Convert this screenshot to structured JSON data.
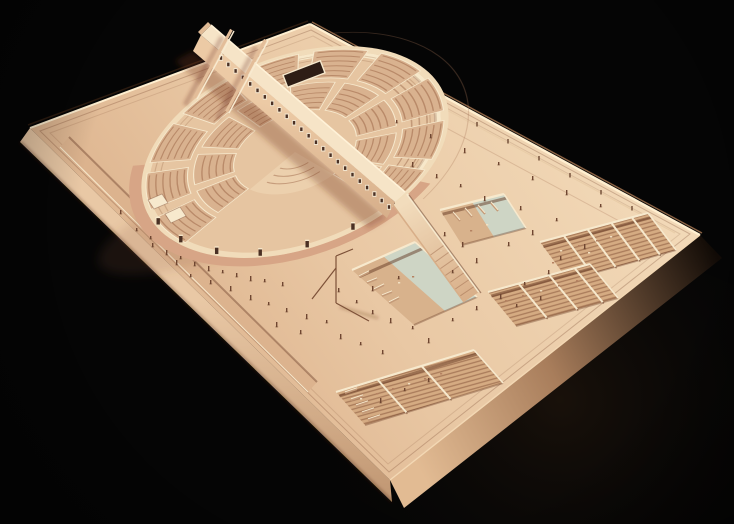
{
  "scene": {
    "description": "Photograph of a wooden architectural scale model on a black background: a circular open-air amphitheater with radial seating blocks, crossed by a long diagonal spine wall with a row of square windows, set on a large tilted rectangular plaza base with sunken rectangular courtyards, a descending ramp, a thin mast, and many tiny human figures.",
    "width": 734,
    "height": 524
  },
  "palette": {
    "bg": "#050505",
    "glow": "rgba(130,80,38,0.16)",
    "plaza_light": "#f4ddbc",
    "plaza_dark": "#d8ab85",
    "rim_groove": "rgba(120,70,45,0.30)",
    "edge_light": "#ffefd0",
    "edge_dark": "#2b1b10",
    "side_sw_hi": "#e9c8a5",
    "side_sw_lo": "#bf9571",
    "se_hi": "#e2bb93",
    "se_mid": "#a87d5b",
    "se_lo": "#120b06",
    "wall_top": "#f1dcba",
    "wall_shadow": "#d7a586",
    "bowl": "#e6c5a1",
    "inner_ne_wall": "#f7e8ca",
    "seat": "#d9b28f",
    "seat_stripe": "#b98a69",
    "stage_floor": "#ecd0ad",
    "cream": "#f7e9cd",
    "spine_top": "#f6e4c7",
    "spine_face_hi": "#eccaa5",
    "spine_face_lo": "#c99d79",
    "window_frame": "#f4e8d2",
    "window_hole": "#4a3024",
    "cast_shadow": "rgba(115,55,35,0.32)",
    "soft_shadow": "rgba(140,85,55,0.16)",
    "green_panel": "#ced5c5",
    "court_floor": "#d5ab82",
    "court_stripe": "#a97b5a",
    "court_wall_dark": "rgba(95,50,30,0.48)",
    "trench": "#dcb38e",
    "figure": "#6f4631",
    "figure_shadow": "rgba(90,50,30,0.40)",
    "mast": "#7d5138",
    "vignette": "rgba(0,0,0,0.36)"
  },
  "platform": {
    "top": [
      [
        310,
        24
      ],
      [
        700,
        235
      ],
      [
        390,
        480
      ],
      [
        30,
        128
      ]
    ],
    "inset1": [
      [
        311,
        30
      ],
      [
        690,
        234
      ],
      [
        389,
        472
      ],
      [
        40,
        131
      ]
    ],
    "inset2": [
      [
        313,
        36
      ],
      [
        680,
        234
      ],
      [
        388,
        464
      ],
      [
        50,
        133
      ]
    ],
    "side_sw": [
      [
        30,
        128
      ],
      [
        390,
        480
      ],
      [
        392,
        502
      ],
      [
        20,
        142
      ]
    ],
    "side_se": [
      [
        390,
        480
      ],
      [
        700,
        235
      ],
      [
        722,
        258
      ],
      [
        404,
        508
      ]
    ],
    "ne_wall_line": [
      [
        328,
        46
      ],
      [
        675,
        233
      ]
    ],
    "ne_seam": [
      [
        320,
        60
      ],
      [
        660,
        243
      ]
    ],
    "posts": [
      [
        383,
        75
      ],
      [
        414,
        92
      ],
      [
        445,
        109
      ],
      [
        477,
        126
      ],
      [
        508,
        143
      ],
      [
        539,
        160
      ],
      [
        570,
        177
      ],
      [
        601,
        194
      ],
      [
        632,
        210
      ]
    ],
    "trench": [
      [
        69,
        137
      ],
      [
        317,
        382
      ],
      [
        308,
        392
      ],
      [
        60,
        147
      ]
    ]
  },
  "drum": {
    "cx": 295,
    "cy": 152,
    "sx": 1.6,
    "sy": 0.96,
    "rot": -20.5,
    "r_outer": 100,
    "r_wall_in": 95,
    "r_bowl": 92,
    "outer_face_arc": [
      48,
      205,
      100,
      108
    ],
    "ne_wall_arc": [
      245,
      420,
      90.5,
      95
    ],
    "seam_r": 113,
    "seam_arc": [
      295,
      415
    ],
    "doors": [
      62,
      80,
      98,
      116,
      134,
      152,
      168
    ],
    "door_r": 98,
    "stage_sector": [
      64,
      150,
      0,
      40
    ],
    "stage_arcs": [
      16,
      23,
      30
    ],
    "terrace_arcs": [
      76,
      81,
      86,
      91
    ],
    "terrace_span": [
      332,
      414
    ],
    "concourse_arcs": [
      88,
      92
    ],
    "screen": {
      "x": 304,
      "y": 74,
      "w": 40,
      "h": 13,
      "rot": -21
    }
  },
  "seating": {
    "bandA": {
      "r": [
        40,
        66
      ],
      "row_step": 4.6,
      "wedges": [
        [
          152,
          178
        ],
        [
          184,
          210
        ],
        [
          216,
          242
        ],
        [
          248,
          274
        ],
        [
          280,
          306
        ],
        [
          312,
          338
        ],
        [
          344,
          370
        ],
        [
          376,
          402
        ],
        [
          404,
          424
        ]
      ]
    },
    "bandB": {
      "r": [
        70,
        97
      ],
      "row_step": 4.6,
      "wedges": [
        [
          150,
          172
        ],
        [
          178,
          200
        ],
        [
          206,
          228
        ],
        [
          234,
          256
        ],
        [
          262,
          284
        ],
        [
          290,
          312
        ],
        [
          318,
          340
        ],
        [
          346,
          368
        ],
        [
          374,
          396
        ],
        [
          402,
          423
        ]
      ]
    }
  },
  "spine": {
    "shadow": [
      [
        193,
        51
      ],
      [
        387,
        218
      ],
      [
        369,
        228
      ],
      [
        175,
        61
      ]
    ],
    "face": [
      [
        201,
        35
      ],
      [
        395,
        202
      ],
      [
        387,
        218
      ],
      [
        193,
        51
      ]
    ],
    "top": [
      [
        211,
        25
      ],
      [
        405,
        192
      ],
      [
        395,
        202
      ],
      [
        201,
        35
      ]
    ],
    "tip_cap": [
      [
        211,
        25
      ],
      [
        201,
        35
      ],
      [
        198,
        32
      ],
      [
        208,
        22
      ]
    ],
    "parapet": [
      [
        211,
        25
      ],
      [
        405,
        192
      ]
    ],
    "windows": {
      "n": 24,
      "from": [
        221,
        58
      ],
      "to": [
        389,
        207
      ],
      "fw": 4,
      "fh": 5.6,
      "hw": 2.4,
      "hh": 3.6
    },
    "fins": [
      {
        "top": [
          [
            234,
            31
          ],
          [
            197,
            99
          ]
        ],
        "shadow": [
          [
            222,
            37
          ],
          [
            185,
            105
          ]
        ]
      },
      {
        "top": [
          [
            268,
            41
          ],
          [
            229,
            113
          ]
        ],
        "shadow": [
          [
            256,
            47
          ],
          [
            217,
            119
          ]
        ]
      }
    ]
  },
  "ramp": {
    "surface": [
      [
        407,
        194
      ],
      [
        479,
        292
      ],
      [
        464,
        302
      ],
      [
        393,
        205
      ]
    ],
    "steps_t": [
      0.52,
      0.59,
      0.66,
      0.73,
      0.8,
      0.87,
      0.94
    ],
    "wall_ne": [
      [
        407,
        194
      ],
      [
        479,
        292
      ]
    ],
    "wall_sw": [
      [
        393,
        205
      ],
      [
        464,
        302
      ]
    ]
  },
  "courts": [
    {
      "name": "court-east",
      "quad": [
        [
          540,
          242
        ],
        [
          648,
          213
        ],
        [
          676,
          250
        ],
        [
          568,
          280
        ]
      ],
      "pattern": "u",
      "partitions": [
        0.22,
        0.44,
        0.66,
        0.85
      ],
      "green": null,
      "steps": []
    },
    {
      "name": "court-mid-right",
      "quad": [
        [
          488,
          292
        ],
        [
          590,
          264
        ],
        [
          618,
          298
        ],
        [
          516,
          326
        ]
      ],
      "pattern": "u",
      "partitions": [
        0.3,
        0.6,
        0.85
      ],
      "green": null,
      "steps": []
    },
    {
      "name": "court-south",
      "quad": [
        [
          336,
          392
        ],
        [
          474,
          350
        ],
        [
          503,
          383
        ],
        [
          365,
          425
        ]
      ],
      "pattern": "u",
      "partitions": [
        0.3,
        0.62
      ],
      "green": null,
      "steps": [
        [
          345,
          393,
          357,
          389
        ],
        [
          351,
          400,
          363,
          396
        ],
        [
          356,
          406,
          368,
          402
        ],
        [
          362,
          413,
          374,
          409
        ],
        [
          368,
          420,
          380,
          416
        ]
      ]
    },
    {
      "name": "court-central-pool",
      "quad": [
        [
          352,
          270
        ],
        [
          415,
          242
        ],
        [
          477,
          297
        ],
        [
          414,
          325
        ]
      ],
      "pattern": null,
      "partitions": [],
      "green": [
        [
          383,
          256
        ],
        [
          415,
          242
        ],
        [
          477,
          297
        ],
        [
          445,
          311
        ]
      ],
      "steps": [
        [
          359,
          277,
          369,
          272
        ],
        [
          367,
          283,
          377,
          279
        ],
        [
          374,
          290,
          384,
          285
        ],
        [
          382,
          296,
          392,
          292
        ],
        [
          389,
          303,
          399,
          298
        ]
      ]
    },
    {
      "name": "court-ramp-side",
      "quad": [
        [
          440,
          210
        ],
        [
          504,
          194
        ],
        [
          526,
          228
        ],
        [
          462,
          245
        ]
      ],
      "pattern": null,
      "partitions": [],
      "green": [
        [
          472,
          202
        ],
        [
          504,
          194
        ],
        [
          526,
          228
        ],
        [
          494,
          237
        ]
      ],
      "steps": [
        [
          453,
          213,
          460,
          221
        ],
        [
          465,
          209,
          472,
          217
        ],
        [
          478,
          206,
          485,
          214
        ],
        [
          491,
          203,
          498,
          211
        ]
      ]
    }
  ],
  "court_details": [
    [
      560,
      250
    ],
    [
      578,
      245
    ],
    [
      596,
      240
    ],
    [
      610,
      236
    ],
    [
      552,
      262
    ],
    [
      570,
      257
    ],
    [
      588,
      252
    ],
    [
      505,
      300
    ],
    [
      522,
      295
    ],
    [
      540,
      290
    ],
    [
      558,
      285
    ],
    [
      576,
      280
    ],
    [
      360,
      398
    ],
    [
      376,
      393
    ],
    [
      392,
      388
    ],
    [
      408,
      383
    ],
    [
      424,
      378
    ],
    [
      440,
      373
    ],
    [
      398,
      282
    ],
    [
      412,
      276
    ],
    [
      470,
      230
    ],
    [
      486,
      224
    ]
  ],
  "stair_blocks": [
    [
      [
        148,
        200
      ],
      [
        162,
        194
      ],
      [
        168,
        203
      ],
      [
        154,
        209
      ]
    ],
    [
      [
        165,
        214
      ],
      [
        180,
        207
      ],
      [
        186,
        216
      ],
      [
        171,
        223
      ]
    ]
  ],
  "mast": {
    "lines": [
      [
        336,
        256,
        336,
        303
      ],
      [
        336,
        303,
        369,
        321
      ],
      [
        336,
        256,
        353,
        249
      ],
      [
        336,
        268,
        312,
        299
      ]
    ],
    "shadow": [
      340,
      307,
      378,
      318
    ]
  },
  "figures": [
    [
      150,
      236
    ],
    [
      152,
      243
    ],
    [
      166,
      250
    ],
    [
      180,
      256
    ],
    [
      194,
      262
    ],
    [
      208,
      266
    ],
    [
      222,
      270
    ],
    [
      236,
      273
    ],
    [
      250,
      276
    ],
    [
      264,
      279
    ],
    [
      282,
      282
    ],
    [
      176,
      260
    ],
    [
      190,
      274
    ],
    [
      210,
      280
    ],
    [
      230,
      286
    ],
    [
      136,
      228
    ],
    [
      120,
      210
    ],
    [
      250,
      295
    ],
    [
      268,
      302
    ],
    [
      286,
      308
    ],
    [
      306,
      314
    ],
    [
      326,
      320
    ],
    [
      300,
      330
    ],
    [
      340,
      334
    ],
    [
      360,
      342
    ],
    [
      382,
      350
    ],
    [
      276,
      322
    ],
    [
      356,
      300
    ],
    [
      372,
      310
    ],
    [
      390,
      318
    ],
    [
      412,
      326
    ],
    [
      338,
      288
    ],
    [
      428,
      338
    ],
    [
      452,
      318
    ],
    [
      476,
      306
    ],
    [
      500,
      294
    ],
    [
      524,
      282
    ],
    [
      548,
      270
    ],
    [
      476,
      258
    ],
    [
      452,
      270
    ],
    [
      508,
      242
    ],
    [
      532,
      230
    ],
    [
      556,
      218
    ],
    [
      520,
      206
    ],
    [
      484,
      196
    ],
    [
      460,
      184
    ],
    [
      436,
      174
    ],
    [
      412,
      162
    ],
    [
      396,
      120
    ],
    [
      430,
      134
    ],
    [
      464,
      148
    ],
    [
      498,
      162
    ],
    [
      532,
      176
    ],
    [
      566,
      190
    ],
    [
      600,
      204
    ],
    [
      560,
      256
    ],
    [
      584,
      244
    ],
    [
      516,
      304
    ],
    [
      540,
      296
    ],
    [
      380,
      398
    ],
    [
      404,
      388
    ],
    [
      428,
      378
    ],
    [
      372,
      286
    ],
    [
      398,
      276
    ],
    [
      444,
      232
    ],
    [
      462,
      242
    ]
  ]
}
